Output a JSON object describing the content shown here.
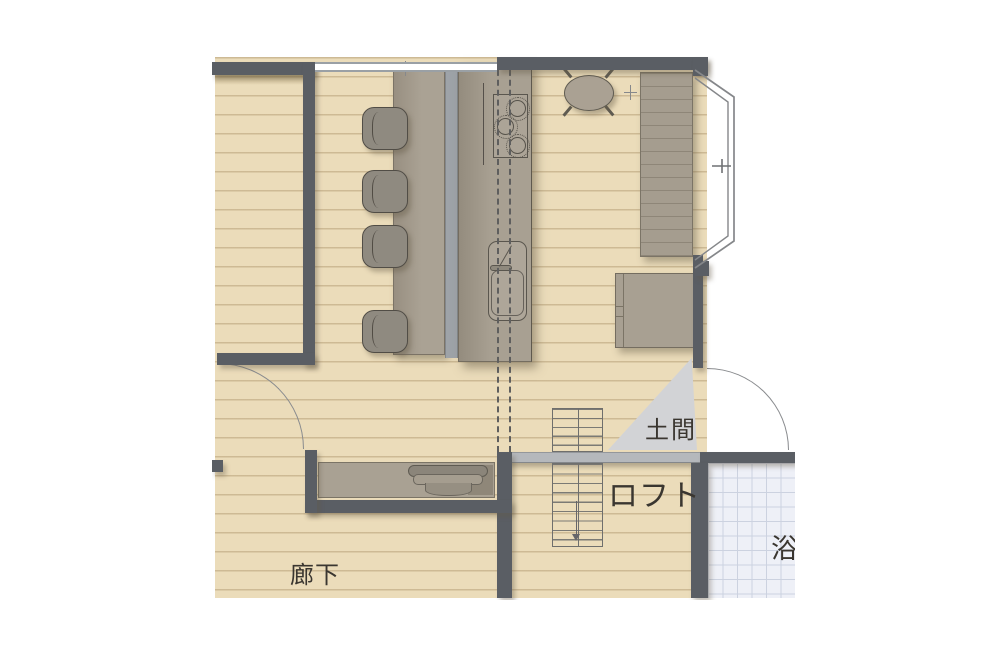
{
  "rooms": {
    "doma": {
      "label": "土間"
    },
    "loft": {
      "label": "ロフト"
    },
    "corridor": {
      "label": "廊下"
    },
    "bath": {
      "label": "浴"
    }
  },
  "fixtures": {
    "stove": "gas-stove-3-burners",
    "sink": "kitchen-sink-with-faucet",
    "kitchen_counter": "kitchen-island-counter",
    "dining_counter": "dining-counter",
    "stools": "counter-stools-x4",
    "table": "round-table-4-legs",
    "window_counter": "window-side-counter",
    "cabinet": "side-cabinet",
    "desk": "built-in-desk-with-chair",
    "stairs": "staircase-with-down-arrow",
    "bay_window": "bay-window",
    "entry_door": "entry-door-swing",
    "room_door": "interior-door-swing"
  },
  "colors": {
    "floor": "#ebdcba",
    "floor_line": "#c5ae85",
    "wall": "#5a5e64",
    "counter": "#a8a092",
    "divider": "#9ea3a8",
    "chair": "#8f8a80",
    "doma": "#d2d3d6",
    "band": "#b5b8bc",
    "tile": "#eef0f7",
    "tile_line": "#ccd2e0",
    "stairs": "#6f6f6d",
    "dash": "#5e5e5e",
    "arc": "#898b8e",
    "text": "#3a3630"
  }
}
